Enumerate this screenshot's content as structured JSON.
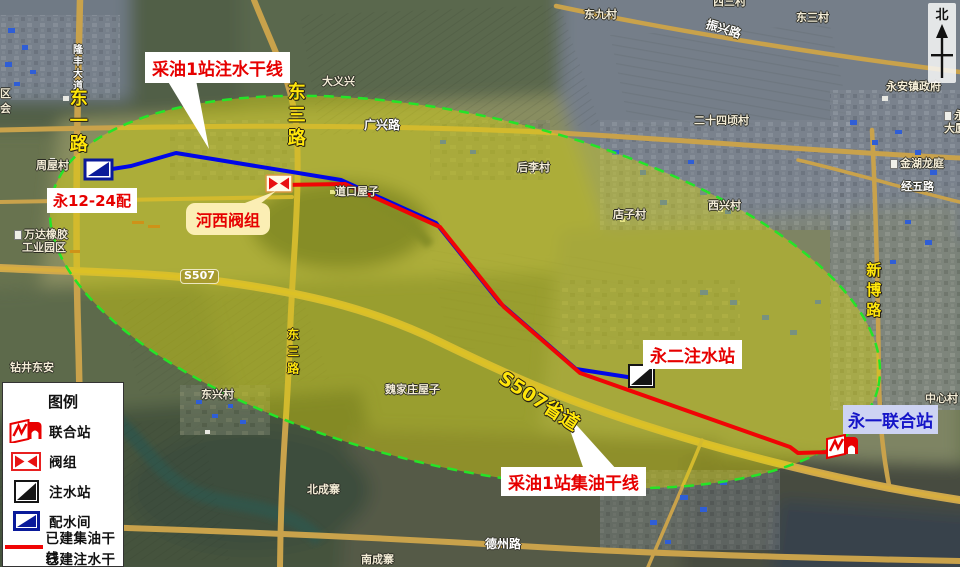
{
  "north_label": "北",
  "legend": {
    "title": "图例",
    "items": [
      {
        "label": "联合站",
        "icon": "joint-station-icon"
      },
      {
        "label": "阀组",
        "icon": "valve-group-icon"
      },
      {
        "label": "注水站",
        "icon": "injection-station-icon"
      },
      {
        "label": "配水间",
        "icon": "water-distribution-icon"
      },
      {
        "label": "已建集油干线",
        "icon": "oil-line-swatch"
      },
      {
        "label": "已建注水干线",
        "icon": "water-line-swatch"
      }
    ]
  },
  "callouts": {
    "injection_main": "采油1站注水干线",
    "hexi_valve": "河西阀组",
    "yong_12_24": "永12-24配",
    "yong2_injection": "永二注水站",
    "gathering_main": "采油1站集油干线",
    "yong1_joint": "永一联合站"
  },
  "colors": {
    "oil_line": "#f00505",
    "water_line": "#0008e8",
    "boundary": "#24e428",
    "overlay_fill": "#e4de00"
  },
  "map_labels": [
    {
      "text": "隆丰大道",
      "x": 70,
      "y": 44,
      "kind": "road-white-v",
      "size": 10
    },
    {
      "text": "东一路",
      "x": 66,
      "y": 88,
      "kind": "road-yellow-v",
      "size": 18
    },
    {
      "text": "东三路",
      "x": 284,
      "y": 82,
      "kind": "road-yellow-v",
      "size": 18
    },
    {
      "text": "东三路",
      "x": 285,
      "y": 328,
      "kind": "road-yellow-v",
      "size": 12
    },
    {
      "text": "新博路",
      "x": 864,
      "y": 262,
      "kind": "road-yellow-v",
      "size": 15
    },
    {
      "text": "S507省道",
      "x": 506,
      "y": 368,
      "kind": "road-yellow-rot",
      "size": 19,
      "angle": 33
    },
    {
      "text": "S507",
      "x": 180,
      "y": 269,
      "kind": "road-badge",
      "size": 11
    },
    {
      "text": "广兴路",
      "x": 364,
      "y": 119,
      "kind": "road-white",
      "size": 12
    },
    {
      "text": "振兴路",
      "x": 708,
      "y": 18,
      "kind": "road-white",
      "size": 12,
      "angle": 17
    },
    {
      "text": "经五路",
      "x": 901,
      "y": 181,
      "kind": "road-white",
      "size": 11
    },
    {
      "text": "德州路",
      "x": 485,
      "y": 538,
      "kind": "road-white",
      "size": 12
    },
    {
      "text": "周屋村",
      "x": 36,
      "y": 160,
      "kind": "village"
    },
    {
      "text": "大义兴",
      "x": 322,
      "y": 76,
      "kind": "village"
    },
    {
      "text": "东九村",
      "x": 584,
      "y": 9,
      "kind": "village"
    },
    {
      "text": "西三村",
      "x": 713,
      "y": -4,
      "kind": "village"
    },
    {
      "text": "东三村",
      "x": 796,
      "y": 12,
      "kind": "village"
    },
    {
      "text": "二十四顷村",
      "x": 694,
      "y": 115,
      "kind": "village"
    },
    {
      "text": "永安镇政府",
      "x": 886,
      "y": 81,
      "kind": "village"
    },
    {
      "text": "金湖龙庭",
      "x": 890,
      "y": 158,
      "kind": "village",
      "icon": true
    },
    {
      "text": "西兴村",
      "x": 708,
      "y": 200,
      "kind": "village"
    },
    {
      "text": "店子村",
      "x": 613,
      "y": 209,
      "kind": "village"
    },
    {
      "text": "后李村",
      "x": 517,
      "y": 162,
      "kind": "village"
    },
    {
      "text": "道口屋子",
      "x": 335,
      "y": 186,
      "kind": "village"
    },
    {
      "text": "魏家庄屋子",
      "x": 385,
      "y": 384,
      "kind": "village"
    },
    {
      "text": "东兴村",
      "x": 201,
      "y": 389,
      "kind": "village"
    },
    {
      "text": "钻井东安",
      "x": 10,
      "y": 362,
      "kind": "village"
    },
    {
      "text": "北成寨",
      "x": 307,
      "y": 484,
      "kind": "village"
    },
    {
      "text": "南成寨",
      "x": 361,
      "y": 554,
      "kind": "village"
    },
    {
      "text": "中心村",
      "x": 925,
      "y": 393,
      "kind": "village"
    },
    {
      "text": "万达橡胶",
      "x": 14,
      "y": 229,
      "kind": "village",
      "icon": true
    },
    {
      "text": "工业园区",
      "x": 22,
      "y": 242,
      "kind": "village"
    },
    {
      "text": "永安",
      "x": 944,
      "y": 110,
      "kind": "village",
      "icon": true
    },
    {
      "text": "大厦",
      "x": 944,
      "y": 123,
      "kind": "village"
    },
    {
      "text": "区",
      "x": 0,
      "y": 88,
      "kind": "village"
    },
    {
      "text": "会",
      "x": 0,
      "y": 103,
      "kind": "village"
    }
  ]
}
